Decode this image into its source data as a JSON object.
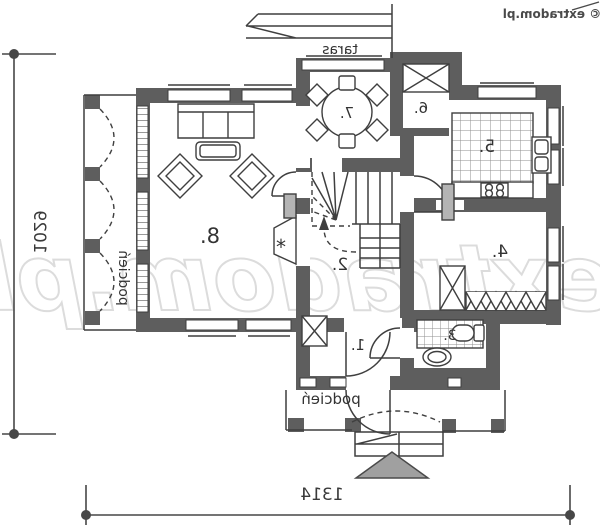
{
  "plan": {
    "watermark_large": "extradom.pl",
    "watermark_small": "© extradom.pl",
    "dimensions": {
      "left": "1029",
      "bottom": "1314"
    },
    "labels": {
      "terrace": "taras",
      "porch_left": "podcień",
      "porch_entry": "podcień",
      "fireplace": "*"
    },
    "rooms": [
      {
        "number": "1."
      },
      {
        "number": "2."
      },
      {
        "number": "3."
      },
      {
        "number": "4."
      },
      {
        "number": "5."
      },
      {
        "number": "6."
      },
      {
        "number": "7."
      },
      {
        "number": "8."
      }
    ],
    "colors": {
      "wall": "#5e5e5e",
      "line": "#3f3f3f",
      "watermark": "#dcdcdc",
      "north_triangle": "#a0a0a0",
      "dim": "#474747"
    }
  }
}
